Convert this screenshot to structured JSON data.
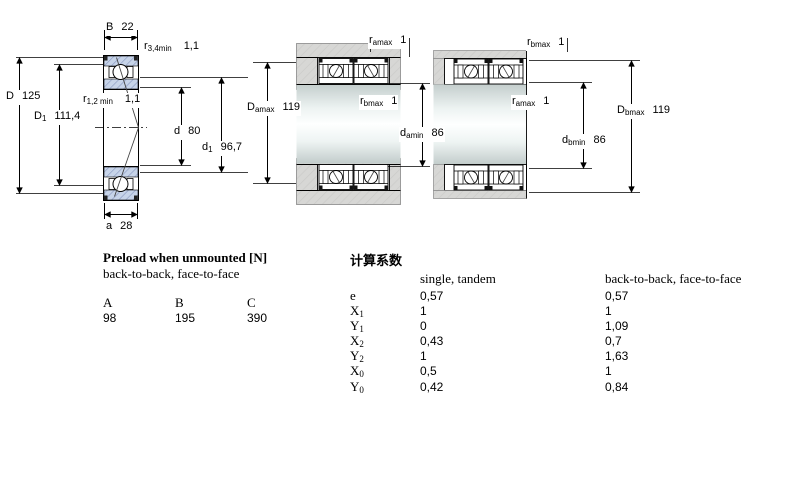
{
  "left_diagram": {
    "B": {
      "base": "B",
      "sub": "",
      "value": "22"
    },
    "r34": {
      "base": "r",
      "sub": "3,4min",
      "value": "1,1"
    },
    "D": {
      "base": "D",
      "sub": "",
      "value": "125"
    },
    "D1": {
      "base": "D",
      "sub": "1",
      "value": "111,4"
    },
    "r12": {
      "base": "r",
      "sub": "1,2 min",
      "value": "1,1"
    },
    "d": {
      "base": "d",
      "sub": "",
      "value": "80"
    },
    "d1": {
      "base": "d",
      "sub": "1",
      "value": "96,7"
    },
    "a": {
      "base": "a",
      "sub": "",
      "value": "28"
    }
  },
  "middle_diagram": {
    "ra_top": {
      "base": "r",
      "sub": "amax",
      "value": "1"
    },
    "Da": {
      "base": "D",
      "sub": "amax",
      "value": "119"
    },
    "rb_mid": {
      "base": "r",
      "sub": "bmax",
      "value": "1"
    },
    "da": {
      "base": "d",
      "sub": "amin",
      "value": "86"
    }
  },
  "right_diagram": {
    "rb_top": {
      "base": "r",
      "sub": "bmax",
      "value": "1"
    },
    "ra_mid": {
      "base": "r",
      "sub": "amax",
      "value": "1"
    },
    "Db": {
      "base": "D",
      "sub": "bmax",
      "value": "119"
    },
    "db": {
      "base": "d",
      "sub": "bmin",
      "value": "86"
    }
  },
  "preload_table": {
    "title": "Preload when unmounted [N]",
    "subtitle": "back-to-back, face-to-face",
    "columns": [
      "A",
      "B",
      "C"
    ],
    "values": [
      "98",
      "195",
      "390"
    ]
  },
  "factors_table": {
    "title": "计算系数",
    "col1_header": "single, tandem",
    "col2_header": "back-to-back, face-to-face",
    "rows": [
      {
        "base": "e",
        "sub": "",
        "v1": "0,57",
        "v2": "0,57"
      },
      {
        "base": "X",
        "sub": "1",
        "v1": "1",
        "v2": "1"
      },
      {
        "base": "Y",
        "sub": "1",
        "v1": "0",
        "v2": "1,09"
      },
      {
        "base": "X",
        "sub": "2",
        "v1": "0,43",
        "v2": "0,7"
      },
      {
        "base": "Y",
        "sub": "2",
        "v1": "1",
        "v2": "1,63"
      },
      {
        "base": "X",
        "sub": "0",
        "v1": "0,5",
        "v2": "1"
      },
      {
        "base": "Y",
        "sub": "0",
        "v1": "0,42",
        "v2": "0,84"
      }
    ]
  },
  "colors": {
    "bearing_ring_fill": "#c7d4e9",
    "bearing_hatch_line": "#8897c0",
    "housing_gray": "#d7d7d5",
    "shaft_highlight": "#feffff",
    "outline": "#000000"
  }
}
